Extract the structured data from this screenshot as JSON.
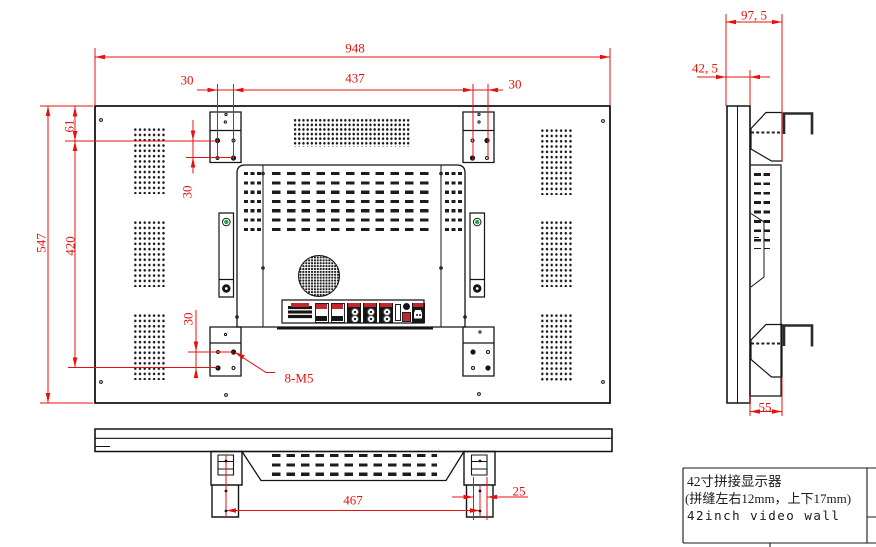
{
  "drawing": {
    "kind": "technical-drawing",
    "views": {
      "rear": {
        "dims": {
          "overall_width": "948",
          "overall_height": "547",
          "hole_span_horizontal": "437",
          "hole_offset_left": "30",
          "hole_offset_right": "30",
          "edge_to_hole_top": "61",
          "hole_span_vertical": "420",
          "bracket_pitch_top": "30",
          "bracket_pitch_bottom": "30",
          "thread_callout": "8-M5"
        }
      },
      "side": {
        "dims": {
          "depth_overall": "97, 5",
          "depth_panel": "42, 5",
          "bracket_width": "55"
        }
      },
      "bottom": {
        "dims": {
          "bracket_span": "467",
          "bracket_offset": "25"
        }
      }
    },
    "title_block": {
      "product_cn": "42寸拼接显示器",
      "seam_note": "(拼缝左右12mm，上下17mm)",
      "product_en": "42inch video wall"
    },
    "colors": {
      "dimension_red": "#e8100c",
      "outline_black": "#141414",
      "screw_green": "#21a84c",
      "port_red": "#c1272d"
    }
  }
}
